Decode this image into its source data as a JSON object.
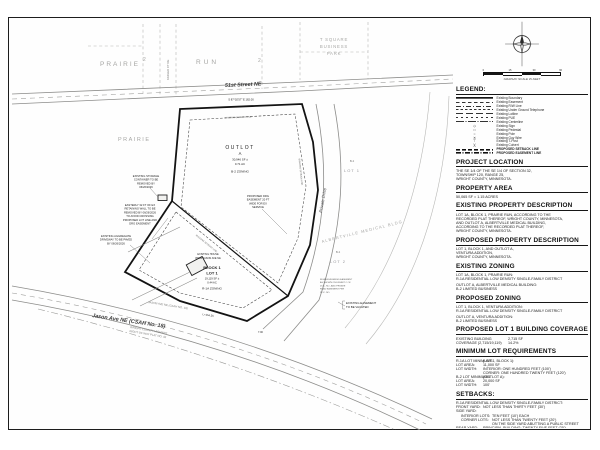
{
  "compass": {
    "caption": "GRAPHIC SCALE IN FEET",
    "ticks": [
      "0",
      "15",
      "30",
      "60"
    ]
  },
  "legend": {
    "title": "LEGEND:",
    "items": [
      {
        "label": "Existing Boundary"
      },
      {
        "label": "Existing Easement"
      },
      {
        "label": "Existing R/W Line"
      },
      {
        "label": "Existing Under Ground Telephone"
      },
      {
        "label": "Existing Lotline"
      },
      {
        "label": "Existing PUE"
      },
      {
        "label": "Existing Centerline"
      },
      {
        "label": "Existing Sign",
        "glyph": "◇"
      },
      {
        "label": "Existing Pedestal",
        "glyph": "□"
      },
      {
        "label": "Existing Pole",
        "glyph": "○"
      },
      {
        "label": "Existing Guy Wire",
        "glyph": "✕"
      },
      {
        "label": "Existing T-Post",
        "glyph": "⊤"
      },
      {
        "label": "Existing Culvert",
        "glyph": ")("
      },
      {
        "label": "PROPOSED SETBACK LINE"
      },
      {
        "label": "PROPOSED EASEMENT LINE"
      }
    ]
  },
  "sections": {
    "project_location": {
      "title": "PROJECT LOCATION",
      "lines": [
        "THE SE 1/4 OF THE SE 1/4 OF SECTION 32,",
        "TOWNSHIP 120, RANGE 25,",
        "WRIGHT COUNTY, MINNESOTA."
      ]
    },
    "property_area": {
      "title": "PROPERTY  AREA",
      "lines": [
        "50,065 SF  =  1.15 ACRES"
      ]
    },
    "existing_property_description": {
      "title": "EXISTING PROPERTY DESCRIPTION",
      "lines": [
        "LOT 1A, BLOCK 1, PRAIRIE RUN, ACCORDING TO THE",
        "RECORDED PLAT THEREOF, WRIGHT COUNTY, MINNESOTA,",
        "AND OUTLOT A, ALBERTVILLE MEDICAL BUILDING,",
        "ACCORDING TO THE RECORDED PLAT THEREOF,",
        "WRIGHT COUNTY, MINNESOTA."
      ]
    },
    "proposed_property_description": {
      "title": "PROPOSED PROPERTY DESCRIPTION",
      "lines": [
        "LOT 1, BLOCK 1, AND OUTLOT A,",
        "VENTURA ADDITION,",
        "WRIGHT COUNTY, MINNESOTA."
      ]
    },
    "existing_zoning": {
      "title": "EXISTING ZONING",
      "groups": [
        [
          "LOT 1A, BLOCK 1, PRAIRIE RUN:",
          "R-1A RESIDENTIAL LOW DENSITY SINGLE-FAMILY DISTRICT"
        ],
        [
          "OUTLOT A, ALBERTVILLE MEDICAL BUILDING:",
          "B-2 LIMITED BUSINESS"
        ]
      ]
    },
    "proposed_zoning": {
      "title": "PROPOSED ZONING",
      "groups": [
        [
          "LOT 1, BLOCK 1, VENTURA ADDITION:",
          "R-1A RESIDENTIAL LOW DENSITY SINGLE-FAMILY DISTRICT"
        ],
        [
          "OUTLOT A, VENTURA ADDITION:",
          "B-2 LIMITED BUSINESS"
        ]
      ]
    },
    "building_coverage": {
      "title": "PROPOSED LOT 1 BUILDING COVERAGE",
      "rows": [
        [
          "EXISTING BUILDING",
          "2,715 SF"
        ],
        [
          "COVERAGE (2,715/19,119)",
          "14.2%"
        ]
      ]
    },
    "min_lot": {
      "title": "MINIMUM LOT REQUIREMENTS",
      "rows": [
        [
          "R-1A LOT MINIMUMS",
          "(LOT 1, BLOCK 1):"
        ],
        [
          "LOT AREA:",
          "11,000 SF"
        ],
        [
          "LOT WIDTH:",
          "INTERIOR: ONE HUNDRED FEET (100')"
        ],
        [
          "",
          "CORNER: ONE HUNDRED TWENTY FEET (120')"
        ],
        [
          "B-2 LOT MINIMUMS",
          "(OUTLOT A):"
        ],
        [
          "LOT AREA:",
          "20,000 SF"
        ],
        [
          "LOT WIDTH:",
          "100'"
        ]
      ]
    },
    "setbacks": {
      "title": "SETBACKS:",
      "rows": [
        [
          "R-1A RESIDENTIAL LOW DENSITY SINGLE-FAMILY DISTRICT:",
          ""
        ],
        [
          "FRONT YARD:",
          "NOT LESS THAN THIRTY FEET (30')"
        ],
        [
          "SIDE YARD:",
          ""
        ],
        [
          "INTERIOR LOTS:",
          "TEN FEET (10') EACH"
        ],
        [
          "CORNER LOTS:",
          "NOT LESS THAN TWENTY FEET (20')"
        ],
        [
          "",
          "ON THE SIDE YARD ABUTTING A PUBLIC STREET"
        ],
        [
          "REAR YARD:",
          "PRINCIPAL BUILDING: TWENTY-FIVE FEET (25')"
        ],
        [
          "B-2 LIMITED BUSINESS:",
          ""
        ],
        [
          "FRONT YARD:",
          "NOT LESS THAN THIRTY-FIVE FEET (35')"
        ],
        [
          "SIDE YARD:",
          "NOT LESS THAN TEN FEET (10') ON ANY ONE SIDE,"
        ],
        [
          "",
          "NOT LESS THAN TWENTY FEET (20') ON THE SIDE"
        ],
        [
          "",
          "YARD ABUTTING A MAJOR STREET"
        ],
        [
          "REAR YARD:",
          "THIRTY FEET (30')"
        ]
      ]
    }
  },
  "drawing": {
    "plats": {
      "prairie_top": "PRAIRIE",
      "num_a": "2",
      "run": "RUN",
      "num_b": "2",
      "tsquare": [
        "T SQUARE",
        "BUSINESS",
        "PARK"
      ],
      "prairie_left": "PRAIRIE",
      "adjacent_plat": "ALBERTVILLE MEDICAL BLDG"
    },
    "roads": {
      "street51": "51st Street NE",
      "kadler": "KADLER CT NE",
      "private_drive": "Private Drive",
      "jason": "Jason Ave NE (CSAH No. 18)",
      "jason_small": "JASON AVE NE (CSAH NO. 18)",
      "wright_row": [
        "WRIGHT COUNTY HIGHWAY",
        "RIGHT OF WAY PLAT NO. 42"
      ]
    },
    "outlot": {
      "l1": "OUTLOT",
      "l2": "A",
      "l3": "30,946 SF ±",
      "l4": "0.71 AC",
      "l5": "B-2 ZONING"
    },
    "lot1": {
      "l1": "BLOCK 1",
      "l2": "LOT 1",
      "l3": "19,119 SF ±",
      "l4": "0.44 AC",
      "l5": "R-1A ZONING"
    },
    "house": [
      "EXISTING HOUSE",
      "#5150 JASON AVE NE"
    ],
    "adjacent": {
      "b2_a": "B-2",
      "lot1": "LOT 1",
      "b2_b": "B-2",
      "lot2": "LOT 2"
    },
    "callouts": {
      "storage": [
        "EXISTING STORAGE",
        "CONTAINER TO BE",
        "REMOVED BY",
        "06/26/2026"
      ],
      "wall": [
        "EASTERLY 32 FT OF EX",
        "RETAINING WALL TO BE",
        "REMOVED BY 06/26/2026",
        "TO AVOID CROSSING",
        "PROPOSED LOT LINE AND",
        "DRG EASEMENT"
      ],
      "driveway": [
        "EXISTING AGGREGATE",
        "DRIVEWAY TO BE PAVED",
        "BY 06/26/2026"
      ],
      "drg": [
        "PROPOSED DRG",
        "EASEMENT 20 FT",
        "WIDE FOR EX",
        "SERVICE"
      ],
      "ingress": [
        "INGRESS/EGRESS EASEMENT",
        "AS SHOWN ON EXHIBIT C OF",
        "DOC. NO., AND PRIVATE",
        "ROAD EASEMENT PER",
        "DOC. NO."
      ],
      "vacate": [
        "EXISTING EASEMENT",
        "TO BE VACATED"
      ]
    },
    "labels": {
      "setback_line": "BUILDING SETBACK LINE"
    },
    "dims": {
      "north": "S 87°02'57\" E   182.00",
      "curve": "L=154.35",
      "d7": "7.00"
    }
  }
}
